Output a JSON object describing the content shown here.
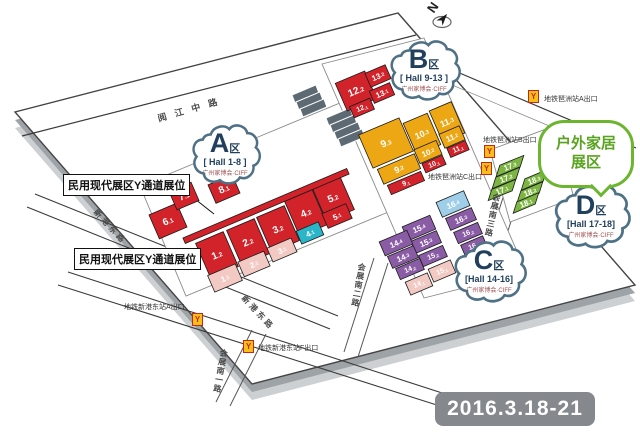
{
  "meta": {
    "date": "2016.3.18-21"
  },
  "icons": {
    "metro": "Y",
    "north": "N"
  },
  "colors": {
    "red": "#d2232a",
    "yellow": "#eda714",
    "purple": "#8a5ca5",
    "pink": "#f2cac3",
    "teal": "#2ab5c9",
    "lightblue": "#9fcfe8",
    "green": "#7cb542",
    "gray": "#5d6a74",
    "cloud_border": "#4f7186",
    "bubble_green": "#6cb52f",
    "badge_gray": "#85898e"
  },
  "area_badges": [
    {
      "letter": "A",
      "zone": "区",
      "range": "[ Hall 1-8 ]",
      "org": "广州家博会·CIFF"
    },
    {
      "letter": "B",
      "zone": "区",
      "range": "[ Hall 9-13 ]",
      "org": "广州家博会·CIFF"
    },
    {
      "letter": "C",
      "zone": "区",
      "range": "[Hall 14-16]",
      "org": "广州家博会·CIFF"
    },
    {
      "letter": "D",
      "zone": "区",
      "range": "[Hall 17-18]",
      "org": "广州家博会·CIFF"
    }
  ],
  "outdoor_bubble": {
    "line1": "户外家居",
    "line2": "展区"
  },
  "callouts": [
    {
      "text": "民用现代展区Y通道展位"
    },
    {
      "text": "民用现代展区Y通道展位"
    }
  ],
  "streets": [
    {
      "name": "阅 江 中 路",
      "x": 156,
      "y": 112,
      "rot": -16,
      "vert": false,
      "fs": 9
    },
    {
      "name": "新港东路",
      "x": 99,
      "y": 207,
      "rot": 47,
      "vert": false,
      "fs": 8
    },
    {
      "name": "新港东路",
      "x": 247,
      "y": 293,
      "rot": 47,
      "vert": false,
      "fs": 8
    },
    {
      "name": "会展南一路",
      "x": 219,
      "y": 348,
      "rot": 10,
      "vert": true,
      "fs": 8
    },
    {
      "name": "会展南二路",
      "x": 357,
      "y": 262,
      "rot": 10,
      "vert": true,
      "fs": 8
    },
    {
      "name": "会展南三路",
      "x": 492,
      "y": 192,
      "rot": 12,
      "vert": true,
      "fs": 8
    }
  ],
  "metro_exits": [
    {
      "label": "地铁琶洲站A出口",
      "ix": 528,
      "iy": 90,
      "lx": 544,
      "ly": 94
    },
    {
      "label": "地铁琶洲站B出口",
      "ix": 484,
      "iy": 145,
      "lx": 483,
      "ly": 135
    },
    {
      "label": "地铁琶洲站C出口",
      "ix": 481,
      "iy": 162,
      "lx": 428,
      "ly": 172
    },
    {
      "label": "地铁新港东站A出口",
      "ix": 192,
      "iy": 313,
      "lx": 124,
      "ly": 302
    },
    {
      "label": "地铁新港东站F出口",
      "ix": 243,
      "iy": 340,
      "lx": 258,
      "ly": 343
    }
  ],
  "halls": [
    {
      "id": "1.2",
      "cx": 217,
      "cy": 255,
      "w": 30,
      "h": 38,
      "c": "red",
      "fs": 10
    },
    {
      "id": "2.2",
      "cx": 248,
      "cy": 242,
      "w": 30,
      "h": 38,
      "c": "red",
      "fs": 10
    },
    {
      "id": "3.2",
      "cx": 278,
      "cy": 229,
      "w": 30,
      "h": 38,
      "c": "red",
      "fs": 10
    },
    {
      "id": "4.2",
      "cx": 306,
      "cy": 213,
      "w": 30,
      "h": 38,
      "c": "red",
      "fs": 10
    },
    {
      "id": "5.2",
      "cx": 333,
      "cy": 198,
      "w": 30,
      "h": 38,
      "c": "red",
      "fs": 10
    },
    {
      "id": "1.1",
      "cx": 225,
      "cy": 278,
      "w": 30,
      "h": 18,
      "c": "pink",
      "fs": 8
    },
    {
      "id": "2.1",
      "cx": 254,
      "cy": 264,
      "w": 28,
      "h": 16,
      "c": "pink",
      "fs": 8
    },
    {
      "id": "3.1",
      "cx": 282,
      "cy": 250,
      "w": 26,
      "h": 15,
      "c": "pink",
      "fs": 8
    },
    {
      "id": "4.1",
      "cx": 310,
      "cy": 233,
      "w": 24,
      "h": 14,
      "c": "teal",
      "fs": 8
    },
    {
      "id": "5.1",
      "cx": 337,
      "cy": 216,
      "w": 26,
      "h": 16,
      "c": "red",
      "fs": 8
    },
    {
      "id": "6.1",
      "cx": 168,
      "cy": 221,
      "w": 30,
      "h": 26,
      "c": "red",
      "fs": 10
    },
    {
      "id": "7.1",
      "cx": 184,
      "cy": 196,
      "w": 24,
      "h": 20,
      "c": "red",
      "fs": 10
    },
    {
      "id": "8.1",
      "cx": 224,
      "cy": 189,
      "w": 26,
      "h": 20,
      "c": "red",
      "fs": 10
    },
    {
      "id": "",
      "cx": 266,
      "cy": 206,
      "w": 178,
      "h": 6,
      "c": "red",
      "fs": 0
    },
    {
      "id": "12.2",
      "cx": 356,
      "cy": 91,
      "w": 32,
      "h": 30,
      "c": "red",
      "fs": 10
    },
    {
      "id": "12.1",
      "cx": 362,
      "cy": 108,
      "w": 22,
      "h": 12,
      "c": "red",
      "fs": 7
    },
    {
      "id": "13.2",
      "cx": 378,
      "cy": 76,
      "w": 22,
      "h": 15,
      "c": "red",
      "fs": 8
    },
    {
      "id": "13.1",
      "cx": 382,
      "cy": 93,
      "w": 22,
      "h": 13,
      "c": "red",
      "fs": 8
    },
    {
      "id": "9.3",
      "cx": 386,
      "cy": 143,
      "w": 44,
      "h": 36,
      "c": "yellow",
      "fs": 10
    },
    {
      "id": "9.2",
      "cx": 399,
      "cy": 169,
      "w": 40,
      "h": 16,
      "c": "yellow",
      "fs": 9
    },
    {
      "id": "9.1",
      "cx": 406,
      "cy": 183,
      "w": 36,
      "h": 10,
      "c": "red",
      "fs": 7
    },
    {
      "id": "10.3",
      "cx": 422,
      "cy": 134,
      "w": 26,
      "h": 34,
      "c": "yellow",
      "fs": 9
    },
    {
      "id": "10.2",
      "cx": 428,
      "cy": 152,
      "w": 24,
      "h": 15,
      "c": "yellow",
      "fs": 8
    },
    {
      "id": "10.1",
      "cx": 434,
      "cy": 164,
      "w": 22,
      "h": 10,
      "c": "red",
      "fs": 7
    },
    {
      "id": "11.3",
      "cx": 447,
      "cy": 122,
      "w": 24,
      "h": 34,
      "c": "yellow",
      "fs": 9
    },
    {
      "id": "11.2",
      "cx": 452,
      "cy": 137,
      "w": 22,
      "h": 15,
      "c": "yellow",
      "fs": 8
    },
    {
      "id": "11.1",
      "cx": 458,
      "cy": 149,
      "w": 20,
      "h": 10,
      "c": "red",
      "fs": 7
    },
    {
      "id": "16.4",
      "cx": 453,
      "cy": 204,
      "w": 30,
      "h": 16,
      "c": "lightblue",
      "fs": 8
    },
    {
      "id": "16.3",
      "cx": 461,
      "cy": 219,
      "w": 28,
      "h": 13,
      "c": "purple",
      "fs": 8
    },
    {
      "id": "16.2",
      "cx": 468,
      "cy": 233,
      "w": 26,
      "h": 12,
      "c": "purple",
      "fs": 7
    },
    {
      "id": "16.1",
      "cx": 474,
      "cy": 246,
      "w": 24,
      "h": 12,
      "c": "purple",
      "fs": 7
    },
    {
      "id": "15.4",
      "cx": 419,
      "cy": 228,
      "w": 30,
      "h": 15,
      "c": "purple",
      "fs": 8
    },
    {
      "id": "15.3",
      "cx": 426,
      "cy": 242,
      "w": 28,
      "h": 13,
      "c": "purple",
      "fs": 8
    },
    {
      "id": "15.2",
      "cx": 433,
      "cy": 256,
      "w": 26,
      "h": 12,
      "c": "purple",
      "fs": 7
    },
    {
      "id": "15.1",
      "cx": 442,
      "cy": 271,
      "w": 24,
      "h": 14,
      "c": "pink",
      "fs": 7
    },
    {
      "id": "14.4",
      "cx": 396,
      "cy": 243,
      "w": 30,
      "h": 15,
      "c": "purple",
      "fs": 8
    },
    {
      "id": "14.3",
      "cx": 403,
      "cy": 257,
      "w": 28,
      "h": 13,
      "c": "purple",
      "fs": 8
    },
    {
      "id": "14.2",
      "cx": 410,
      "cy": 269,
      "w": 26,
      "h": 12,
      "c": "purple",
      "fs": 7
    },
    {
      "id": "14.1",
      "cx": 419,
      "cy": 284,
      "w": 24,
      "h": 14,
      "c": "pink",
      "fs": 7
    },
    {
      "id": "17.3",
      "cx": 510,
      "cy": 166,
      "w": 26,
      "h": 12,
      "c": "green",
      "fs": 8,
      "b": "d"
    },
    {
      "id": "17.2",
      "cx": 506,
      "cy": 178,
      "w": 26,
      "h": 12,
      "c": "green",
      "fs": 8,
      "b": "d"
    },
    {
      "id": "17.1",
      "cx": 502,
      "cy": 190,
      "w": 26,
      "h": 12,
      "c": "green",
      "fs": 8,
      "b": "d"
    },
    {
      "id": "18.3",
      "cx": 534,
      "cy": 180,
      "w": 24,
      "h": 12,
      "c": "green",
      "fs": 8,
      "b": "d"
    },
    {
      "id": "18.2",
      "cx": 530,
      "cy": 192,
      "w": 24,
      "h": 12,
      "c": "green",
      "fs": 8,
      "b": "d"
    },
    {
      "id": "18.1",
      "cx": 526,
      "cy": 203,
      "w": 24,
      "h": 12,
      "c": "green",
      "fs": 8,
      "b": "d"
    }
  ],
  "deco_stacks": [
    {
      "x": 292,
      "y": 95,
      "n": 3
    },
    {
      "x": 326,
      "y": 118,
      "n": 4
    }
  ]
}
